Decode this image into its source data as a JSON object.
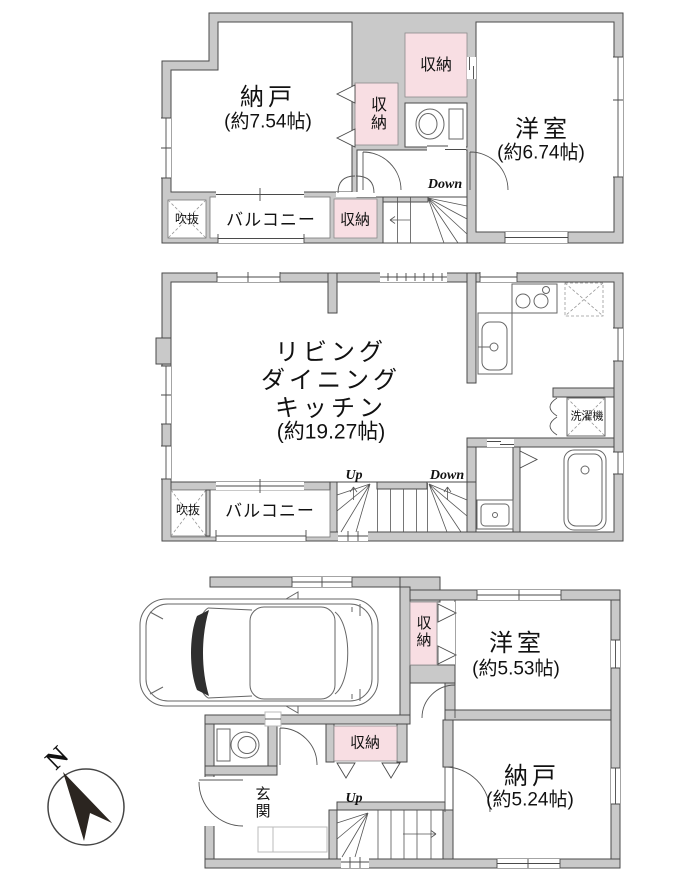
{
  "floor3": {
    "storage_room": "納戸",
    "storage_room_size": "(約7.54帖)",
    "closet_center": "収納",
    "closet_top": "収納",
    "western_room": "洋室",
    "western_room_size": "(約6.74帖)",
    "stairs_down": "Down",
    "void": "吹抜",
    "balcony": "バルコニー",
    "closet_bottom": "収納"
  },
  "floor2": {
    "living": "リビング",
    "dining": "ダイニング",
    "kitchen": "キッチン",
    "ldk_size": "(約19.27帖)",
    "laundry": "洗濯機",
    "stairs_up": "Up",
    "stairs_down": "Down",
    "void": "吹抜",
    "balcony": "バルコニー"
  },
  "floor1": {
    "closet_right": "収納",
    "western_room": "洋室",
    "western_room_size": "(約5.53帖)",
    "closet_center": "収納",
    "storage_room": "納戸",
    "storage_room_size": "(約5.24帖)",
    "entrance": "玄関",
    "stairs_up": "Up"
  },
  "compass": {
    "north": "N"
  },
  "colors": {
    "wall": "#c9c9c9",
    "closet_pink": "#f8dee3",
    "line": "#4a4a4a"
  }
}
